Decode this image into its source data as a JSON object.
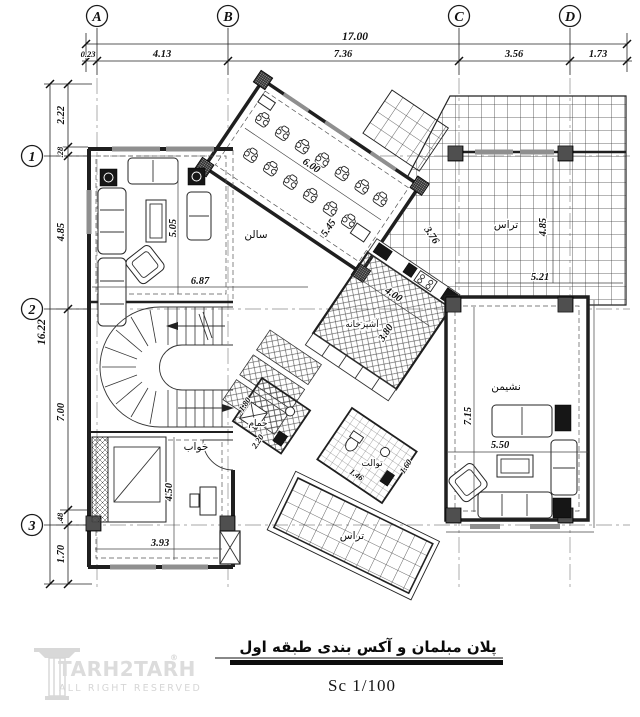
{
  "title_block": {
    "title": "پلان مبلمان و آکس بندی طبقه اول",
    "scale": "Sc 1/100"
  },
  "watermark": {
    "brand": "TARH2TARH",
    "reg": "®",
    "tagline": "ALL RIGHT RESERVED"
  },
  "axes": {
    "cols": [
      {
        "label": "A"
      },
      {
        "label": "B"
      },
      {
        "label": "C"
      },
      {
        "label": "D"
      }
    ],
    "rows": [
      {
        "label": "1"
      },
      {
        "label": "2"
      },
      {
        "label": "3"
      }
    ]
  },
  "dims": {
    "top": {
      "total": "17.00",
      "seg": [
        "0.23",
        "4.13",
        "7.36",
        "3.56",
        "1.73"
      ]
    },
    "side": {
      "total": "16.22",
      "seg": [
        "2.22",
        ".28",
        "4.85",
        "7.00",
        ".48",
        "1.70"
      ]
    }
  },
  "rooms": {
    "salon": {
      "label": "سالن"
    },
    "terrace_top": {
      "label": "تراس"
    },
    "kitchen": {
      "label": "آشپزخانه"
    },
    "sitting": {
      "label": "نشیمن"
    },
    "bedroom": {
      "label": "خواب"
    },
    "bath": {
      "label": "حمام"
    },
    "toilet": {
      "label": "توالت"
    },
    "terrace_bottom": {
      "label": "تراس"
    }
  },
  "m": {
    "salon_len": "6.00",
    "salon_dep": "5.45",
    "living_h": "5.05",
    "living_w": "6.87",
    "ter_diag": "3.76",
    "ter_h": "4.85",
    "ter_w": "5.21",
    "kit_a": "4.00",
    "kit_b": "3.80",
    "sit_h": "7.15",
    "sit_w": "5.50",
    "bed_h": "4.50",
    "bed_w": "3.93",
    "bath_a": "1.80",
    "bath_b": "2.20",
    "wc_a": "1.46",
    "wc_b": "1.60"
  }
}
